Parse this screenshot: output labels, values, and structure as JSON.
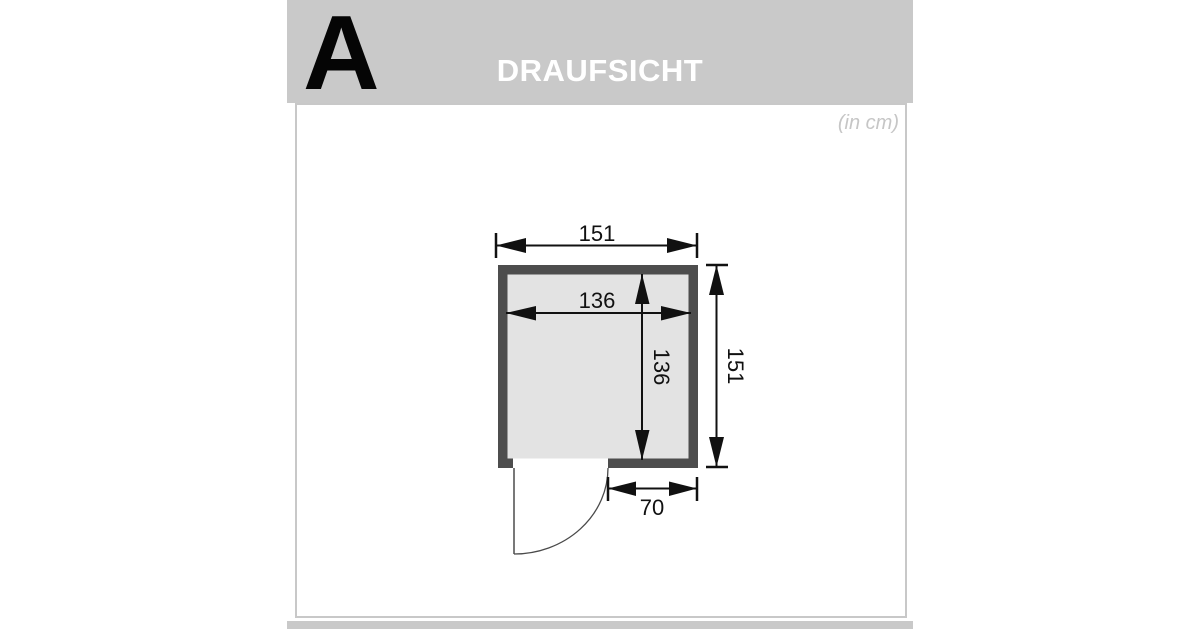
{
  "header": {
    "section_letter": "A",
    "title": "DRAUFSICHT"
  },
  "drawing": {
    "unit_note": "(in cm)",
    "dimensions": {
      "outer_width": "151",
      "outer_height": "151",
      "inner_width": "136",
      "inner_height": "136",
      "door_clearance": "70"
    },
    "colors": {
      "wall": "#4d4d4d",
      "interior": "#e3e3e3",
      "door_opening": "#ffffff"
    }
  }
}
